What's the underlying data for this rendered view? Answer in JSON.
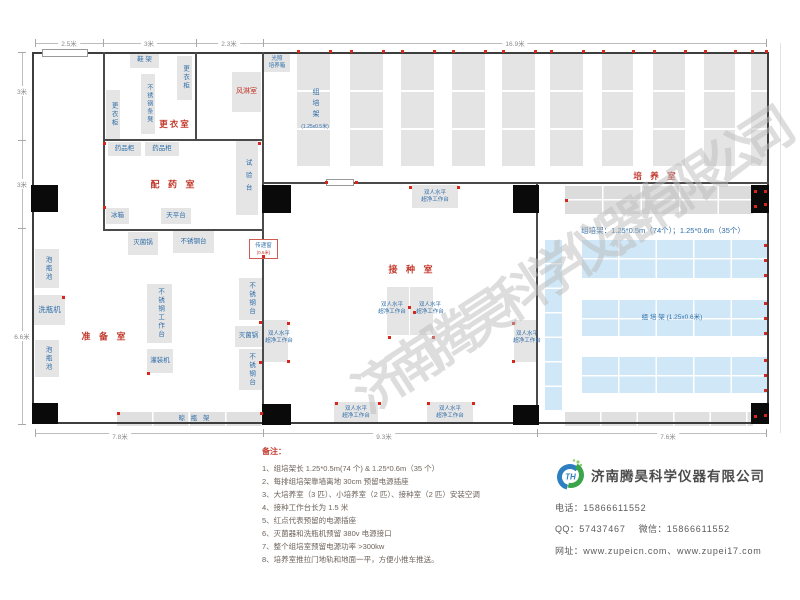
{
  "watermark": "济南腾昊科学仪器有限公司",
  "dimensions": {
    "top": [
      "2.5米",
      "3米",
      "2.3米",
      "16.9米"
    ],
    "left": [
      "3米",
      "3米",
      "6.6米"
    ],
    "bottom": [
      "7.8米",
      "9.3米",
      "7.6米"
    ]
  },
  "rooms": {
    "changing": "更衣室",
    "air_shower": "风淋室",
    "dispensing": "配 药 室",
    "prep": "准 备 室",
    "inoculation": "接 种 室",
    "culture": "培 养 室"
  },
  "equipment": {
    "shoe_rack": "鞋 架",
    "locker": "更衣柜",
    "steel_stool": "不锈钢条凳",
    "medicine_cabinet": "药品柜",
    "test_bench": "试验台",
    "fridge": "冰箱",
    "balance_table": "天平台",
    "soak_pool": "泡瓶池",
    "bottle_washer": "洗瓶机",
    "sterilizer": "灭菌锅",
    "steel_table": "不锈钢台",
    "steel_workbench": "不锈钢工作台",
    "filling_machine": "灌装机",
    "drying_rack": "晾 瓶 架",
    "pass_window": "传递窗",
    "pass_window_size": "(0.6米)",
    "light_incubator_l1": "光照",
    "light_incubator_l2": "培养箱",
    "dual_bench_l1": "双人水平",
    "dual_bench_l2": "超净工作台"
  },
  "shelves": {
    "rack_label_vertical": "组培架",
    "rack_size_small": "(1.25x0.5米)",
    "rack_row_label": "组  培  架 (1.25x0.6米)",
    "summary": "组培架：1.25*0.5m（74个）；1.25*0.6m（35个）"
  },
  "notes": {
    "title": "备注：",
    "items": [
      "1、组培架长 1.25*0.5m(74 个) & 1.25*0.6m（35 个）",
      "2、每排组培架靠墙离地 30cm 预留电源插座",
      "3、大培养室（3 匹）、小培养室（2 匹）、接种室（2 匹）安装空调",
      "4、接种工作台长为 1.5 米",
      "5、红点代表预留的电源插座",
      "6、灭菌器和洗瓶机预留 380v 电源接口",
      "7、整个组培室预留电源功率 >300kw",
      "8、培养室推拉门地轨和地面一平，方便小推车推送。"
    ]
  },
  "company": {
    "name": "济南腾昊科学仪器有限公司",
    "logo_text": "TH",
    "phone_label": "电话：",
    "phone": "15866611552",
    "qq_label": "QQ：",
    "qq": "57437467",
    "wechat_label": "微信：",
    "wechat": "15866611552",
    "web_label": "网址：",
    "websites": "www.zupeicn.com、www.zupei17.com"
  },
  "colors": {
    "room_label": "#c2392d",
    "equipment_label": "#2f6ea8",
    "outlet_dot": "#d4281e",
    "blue_shelf": "#cfe7f6",
    "grey_shelf": "#e4e4e4"
  }
}
